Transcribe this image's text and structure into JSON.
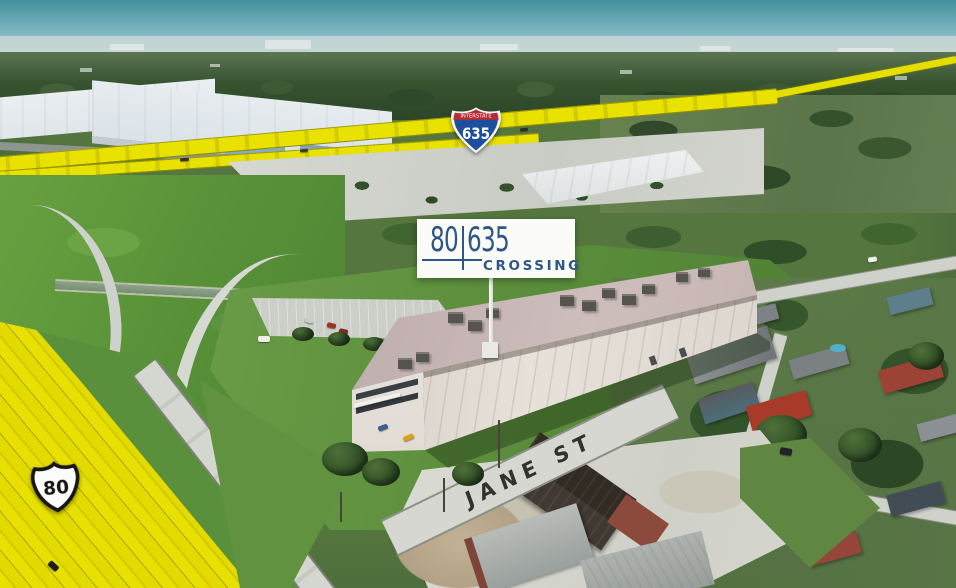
{
  "property_sign": {
    "left_number": "80",
    "right_number": "635",
    "subtitle": "CROSSING",
    "color_navy": "#2d5784",
    "color_card": "#fbfbf8"
  },
  "route_markers": {
    "interstate": {
      "caption": "INTERSTATE",
      "number": "635",
      "shield_blue": "#1d4f9e",
      "band_red": "#bb2a31"
    },
    "us_route": {
      "number": "80"
    }
  },
  "street_marking": {
    "label": "JANE ST",
    "color": "#32322c"
  },
  "highway_highlight": {
    "color": "#e8e000"
  }
}
